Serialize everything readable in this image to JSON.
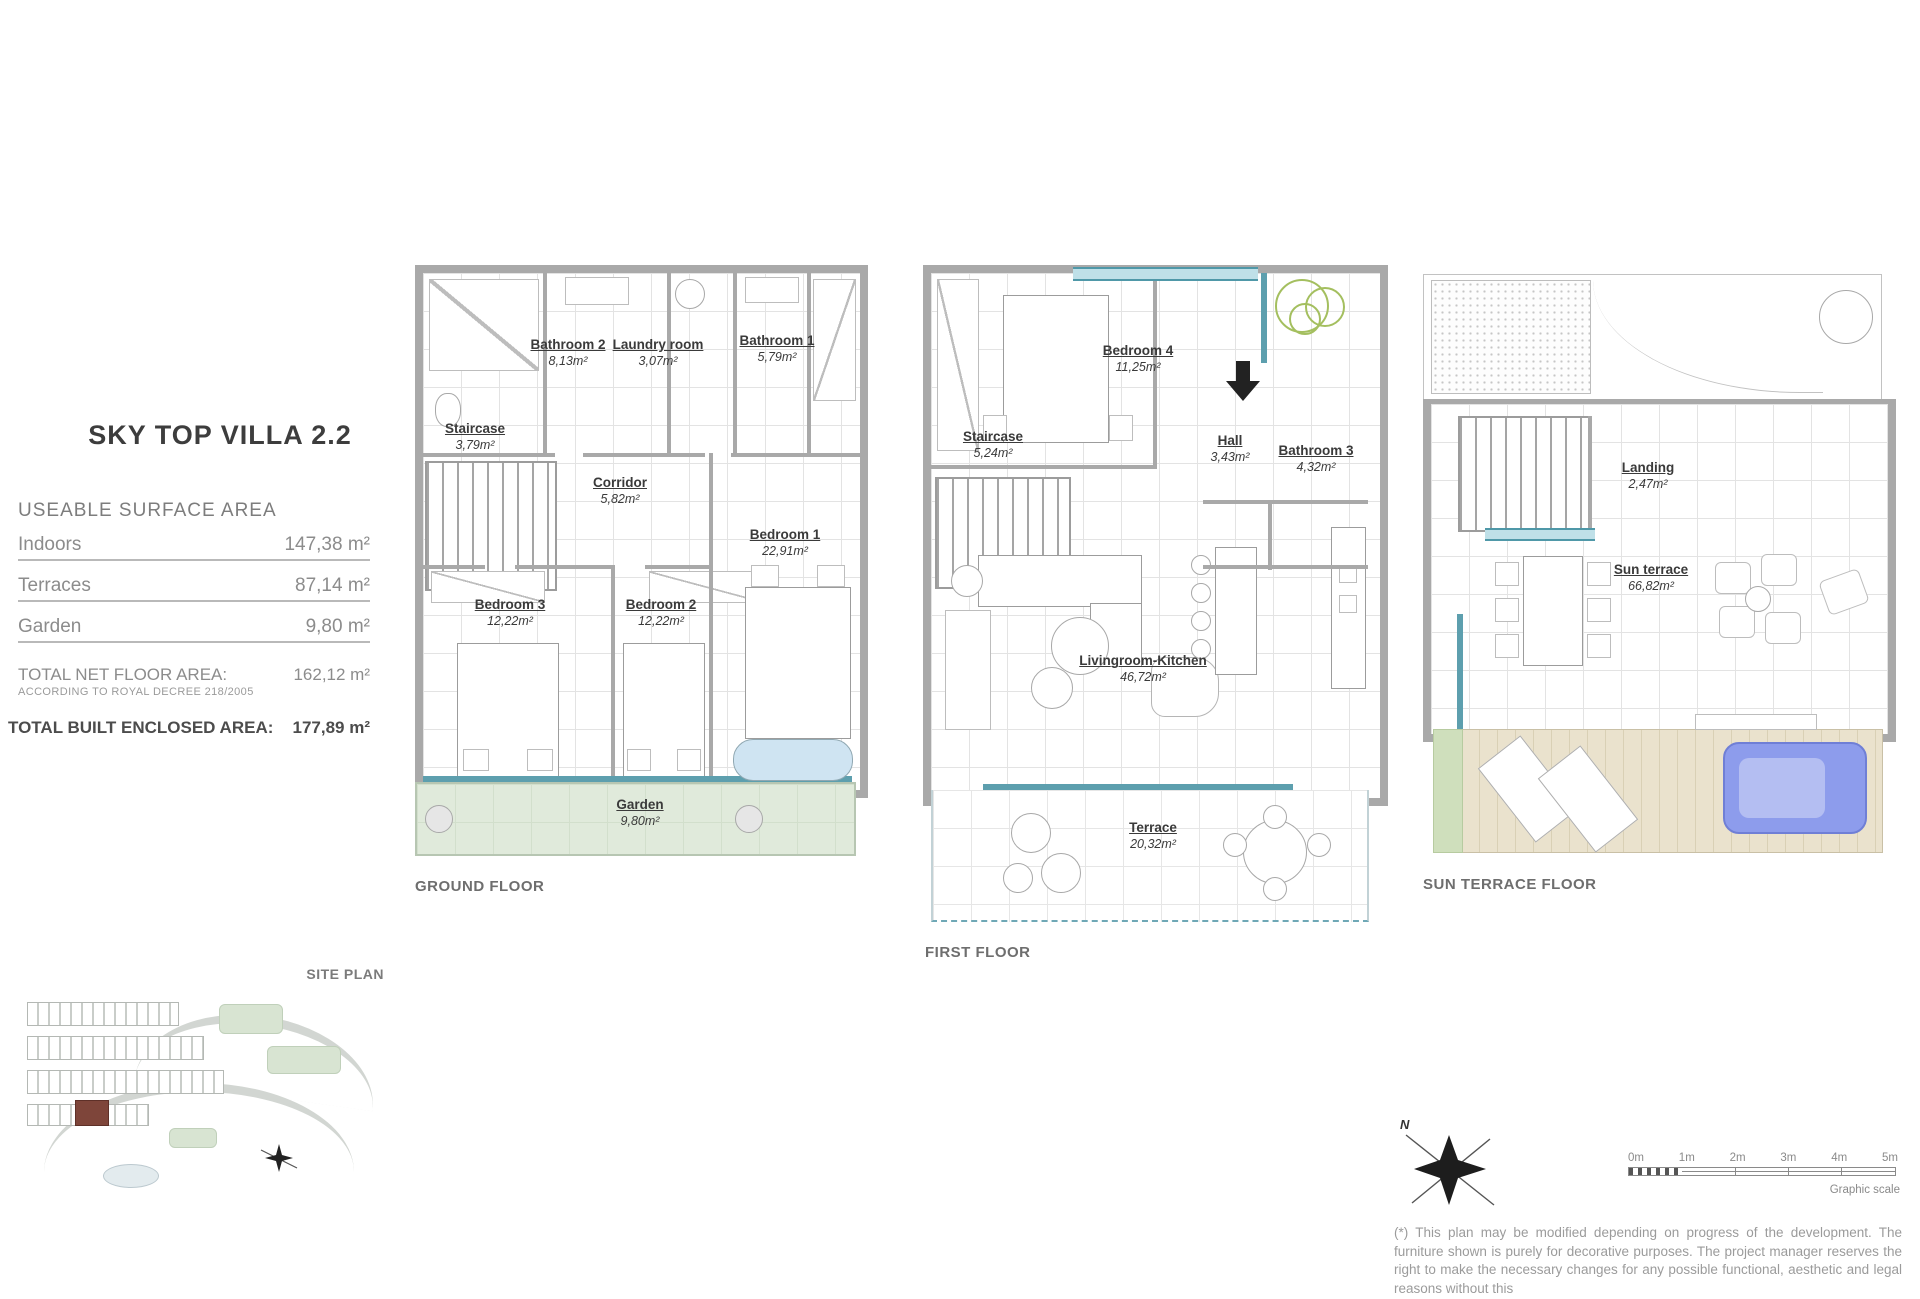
{
  "title": "SKY TOP VILLA 2.2",
  "summary": {
    "heading": "USEABLE SURFACE AREA",
    "rows": [
      {
        "label": "Indoors",
        "value": "147,38 m²"
      },
      {
        "label": "Terraces",
        "value": "87,14 m²"
      },
      {
        "label": "Garden",
        "value": "9,80 m²"
      }
    ],
    "total_net_label": "TOTAL NET FLOOR AREA:",
    "total_net_value": "162,12  m²",
    "total_net_note": "ACCORDING TO ROYAL DECREE 218/2005",
    "total_built_label": "TOTAL BUILT ENCLOSED AREA:",
    "total_built_value": "177,89 m²"
  },
  "floors": [
    {
      "name": "GROUND FLOOR",
      "rooms": [
        {
          "label": "Bathroom 2",
          "area": "8,13m²"
        },
        {
          "label": "Laundry room",
          "area": "3,07m²"
        },
        {
          "label": "Bathroom 1",
          "area": "5,79m²"
        },
        {
          "label": "Staircase",
          "area": "3,79m²"
        },
        {
          "label": "Corridor",
          "area": "5,82m²"
        },
        {
          "label": "Bedroom 3",
          "area": "12,22m²"
        },
        {
          "label": "Bedroom 2",
          "area": "12,22m²"
        },
        {
          "label": "Bedroom 1",
          "area": "22,91m²"
        },
        {
          "label": "Garden",
          "area": "9,80m²"
        }
      ]
    },
    {
      "name": "FIRST FLOOR",
      "rooms": [
        {
          "label": "Bedroom 4",
          "area": "11,25m²"
        },
        {
          "label": "Staircase",
          "area": "5,24m²"
        },
        {
          "label": "Hall",
          "area": "3,43m²"
        },
        {
          "label": "Bathroom 3",
          "area": "4,32m²"
        },
        {
          "label": "Livingroom-Kitchen",
          "area": "46,72m²"
        },
        {
          "label": "Terrace",
          "area": "20,32m²"
        }
      ]
    },
    {
      "name": "SUN TERRACE FLOOR",
      "rooms": [
        {
          "label": "Landing",
          "area": "2,47m²"
        },
        {
          "label": "Sun terrace",
          "area": "66,82m²"
        }
      ]
    }
  ],
  "site_plan_label": "SITE PLAN",
  "north_letter": "N",
  "scale_bar": {
    "ticks": [
      "0m",
      "1m",
      "2m",
      "3m",
      "4m",
      "5m"
    ],
    "caption": "Graphic scale"
  },
  "disclaimer": "(*) This plan may be modified depending on progress of the development. The furniture shown is purely for decorative purposes. The project manager reserves the right to make the necessary changes for any possible functional, aesthetic and legal reasons without this",
  "colors": {
    "wall": "#a9a9a9",
    "window_teal": "#4f98a8",
    "garden_green": "#e0eadb",
    "deck_beige": "#eae2cd",
    "sofa_blue": "#8d9cec",
    "plant_green": "#a4bf5f",
    "site_highlight": "#7e453a"
  }
}
